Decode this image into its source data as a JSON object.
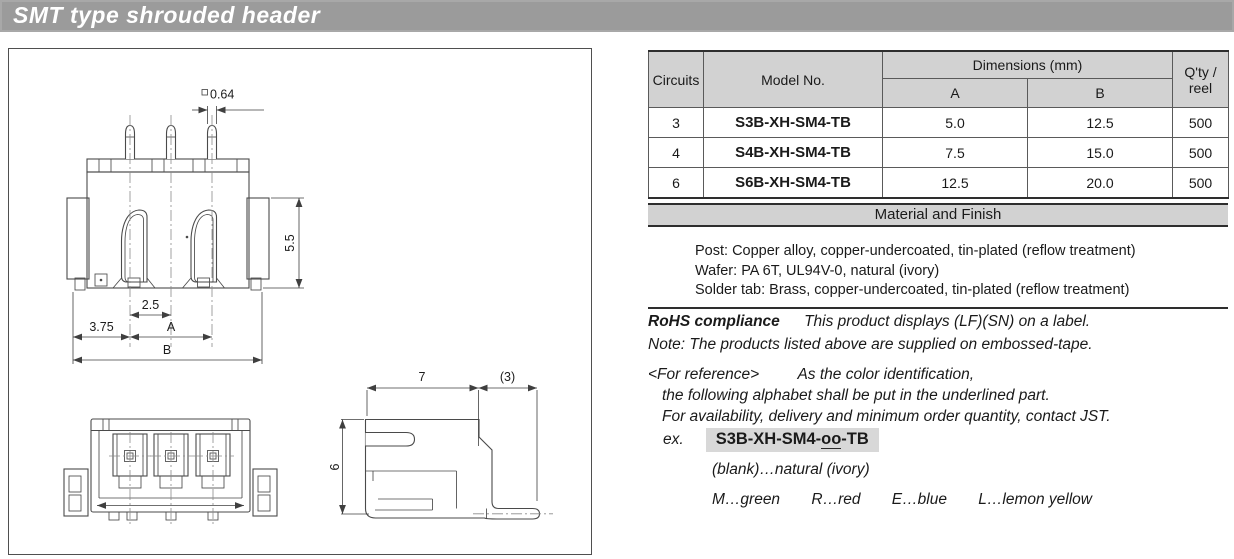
{
  "page": {
    "title": "SMT type shrouded header"
  },
  "colors": {
    "title_bar_bg": "#9b9b9b",
    "table_header_bg": "#d2d2d2",
    "model_highlight_bg": "#d8d8d8",
    "drawing_line": "#4a4a4a"
  },
  "table": {
    "headers": {
      "circuits": "Circuits",
      "model": "Model No.",
      "dimensions": "Dimensions (mm)",
      "a": "A",
      "b": "B",
      "qty_line1": "Q'ty /",
      "qty_line2": "reel"
    },
    "rows": [
      {
        "circuits": "3",
        "model": "S3B-XH-SM4-TB",
        "a": "5.0",
        "b": "12.5",
        "qty": "500"
      },
      {
        "circuits": "4",
        "model": "S4B-XH-SM4-TB",
        "a": "7.5",
        "b": "15.0",
        "qty": "500"
      },
      {
        "circuits": "6",
        "model": "S6B-XH-SM4-TB",
        "a": "12.5",
        "b": "20.0",
        "qty": "500"
      }
    ]
  },
  "material": {
    "header": "Material and Finish",
    "lines": [
      "Post: Copper alloy, copper-undercoated, tin-plated (reflow treatment)",
      "Wafer: PA 6T, UL94V-0, natural (ivory)",
      "Solder tab: Brass, copper-undercoated, tin-plated (reflow treatment)"
    ]
  },
  "rohs": {
    "label": "RoHS compliance",
    "text": "This product displays (LF)(SN) on a label.",
    "note": "Note: The products listed above are supplied on embossed-tape."
  },
  "reference": {
    "tag": "<For reference>",
    "line1": "As the color identification,",
    "line2": "the following alphabet shall be put in the underlined part.",
    "line3": "For availability, delivery and minimum order quantity, contact JST."
  },
  "example": {
    "label": "ex.",
    "model_prefix": "S3B-XH-SM4-",
    "model_colorcode": "oo",
    "model_suffix": "-TB",
    "blank_line": "(blank)…natural (ivory)",
    "color_m": "M…green",
    "color_r": "R…red",
    "color_e": "E…blue",
    "color_l": "L…lemon yellow"
  },
  "drawing": {
    "square_symbol": "□",
    "dim_pin": "0.64",
    "dim_height": "5.5",
    "dim_pitch": "2.5",
    "dim_offset": "3.75",
    "dim_a": "A",
    "dim_b": "B",
    "dim_side_width": "7",
    "dim_side_tab": "(3)",
    "dim_side_height": "6"
  }
}
